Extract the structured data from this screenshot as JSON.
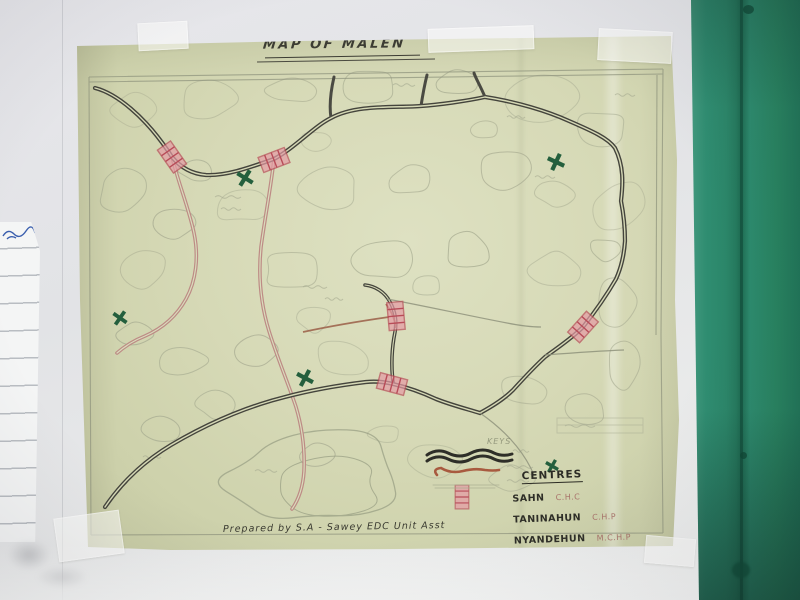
{
  "scene": {
    "description": "Photograph of a hand-drawn map taped to a wall next to a teal door frame",
    "map": {
      "title": "MAP OF MALEN",
      "keys_heading": "KEYS",
      "legend": {
        "heading": "CENTRES",
        "entries": [
          {
            "name": "SAHN",
            "type": "C.H.C"
          },
          {
            "name": "TANINAHUN",
            "type": "C.H.P"
          },
          {
            "name": "NYANDEHUN",
            "type": "M.C.H.P"
          },
          {
            "name": "SENGEMA",
            "type": "C.H.P"
          }
        ]
      },
      "credit": "Prepared by S.A - Sawey EDC Unit Asst",
      "symbols": [
        "double-wavy-road-line",
        "red-minor-road-line",
        "pink-hatched-bridge-rectangle",
        "green-health-centre-cross"
      ],
      "colors": {
        "paper": "#d6d9b6",
        "road_dark": "#44443c",
        "road_pink": "#bd8b85",
        "bridge_pink": "#e59aa4",
        "bridge_stroke": "#b84c58",
        "cross_green": "#245f3d",
        "door_teal": "#2c8a6d",
        "wall": "#e5e6e9"
      }
    }
  }
}
